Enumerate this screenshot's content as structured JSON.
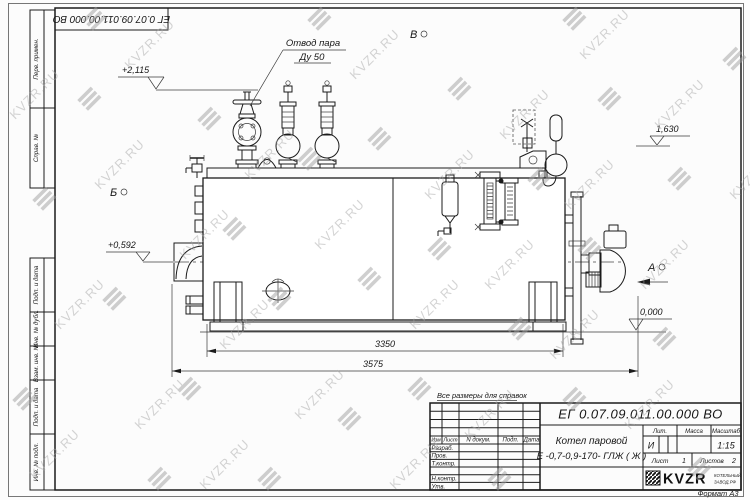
{
  "watermark": {
    "text": "KVZR.RU"
  },
  "frame": {
    "stamp": "ЕГ 0.07.09.011.00.000  ВО",
    "side_labels": [
      "Перв. примен.",
      "Справ. №",
      "Подп. и дата",
      "Инв. № дубл.",
      "Взам. инв. №",
      "Подп. и дата",
      "Инв. № подл."
    ]
  },
  "drawing": {
    "callout": {
      "line1": "Отвод пара",
      "line2": "Ду 50"
    },
    "views": {
      "a": "А",
      "b": "Б",
      "v": "В"
    },
    "elevations": {
      "top": "+2,115",
      "right": "1,630",
      "left": "+0,592",
      "zero": "0,000"
    },
    "dimensions": {
      "inner": "3350",
      "overall": "3575"
    }
  },
  "note": {
    "text": "Все размеры для справок"
  },
  "title_block": {
    "doc_number": "ЕГ 0.07.09.011.00.000  ВО",
    "product": {
      "line1": "Котел паровой",
      "line2": "Е -0,7-0,9-170- ГЛЖ ( Ж )"
    },
    "columns": {
      "izm": "Изм",
      "list": "Лист",
      "doc": "N докум.",
      "sign": "Подп.",
      "date": "Дата"
    },
    "rows": {
      "r1": "Разраб.",
      "r2": "Пров.",
      "r3": "Т.контр.",
      "r4": "Н.контр.",
      "r5": "Утв."
    },
    "props": {
      "lit_label": "Лит.",
      "mass_label": "Масса",
      "scale_label": "Масштаб",
      "lit_value": "И",
      "scale_value": "1:15"
    },
    "sheets": {
      "sheet_label": "Лист",
      "sheet_value": "1",
      "total_label": "Листов",
      "total_value": "2"
    },
    "logo": {
      "text": "KVZR",
      "sub1": "КОТЕЛЬНЫЙ",
      "sub2": "ЗАВОД.РФ"
    },
    "format": "Формат А3"
  }
}
